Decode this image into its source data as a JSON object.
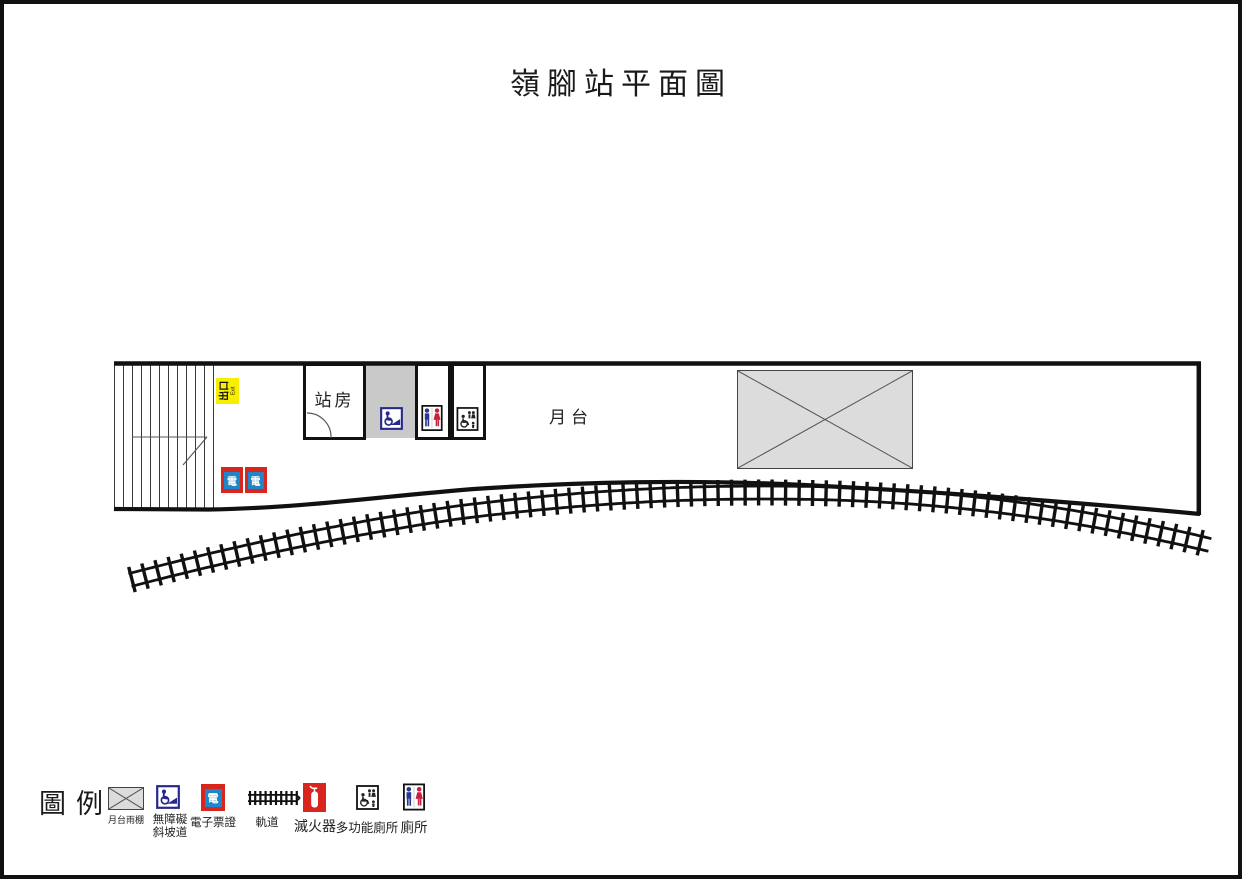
{
  "title": "嶺腳站平面圖",
  "colors": {
    "yellow": "#f8ee00",
    "red": "#d8261e",
    "blue": "#1f86c8",
    "navy": "#28288c",
    "male-blue": "#233a8f",
    "female-red": "#c5203c",
    "gray-fill": "#c9c9c9",
    "canopy-fill": "#dcdcdc"
  },
  "plan": {
    "station_room_label": "站房",
    "platform_label": "月台",
    "exit_sign": {
      "text": "出口",
      "subtext": "Exit"
    },
    "card_reader_char": "電"
  },
  "legend": {
    "heading": "圖例",
    "items": [
      {
        "icon": "platform-canopy",
        "label": "月台雨棚"
      },
      {
        "icon": "wheelchair-ramp",
        "label_line1": "無障礙",
        "label_line2": "斜坡道"
      },
      {
        "icon": "e-ticket",
        "label": "電子票證"
      },
      {
        "icon": "track",
        "label": "軌道"
      },
      {
        "icon": "fire-extinguisher",
        "label": "滅火器"
      },
      {
        "icon": "multi-function-toilet",
        "label": "多功能廁所"
      },
      {
        "icon": "toilet",
        "label": "廁所"
      }
    ]
  }
}
